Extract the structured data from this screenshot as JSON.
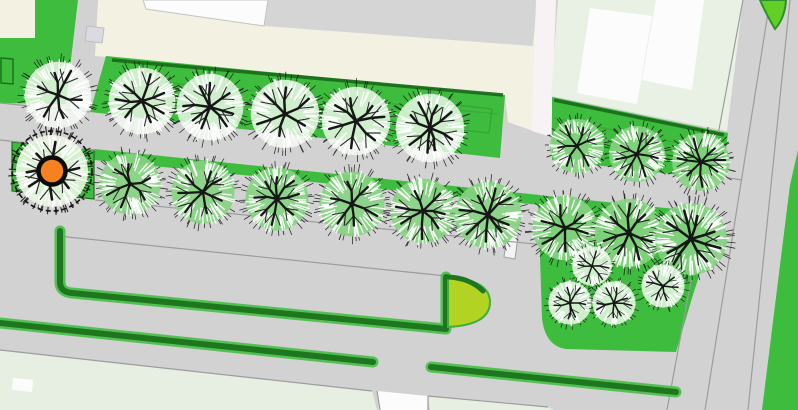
{
  "map": {
    "width": 798,
    "height": 410,
    "colors": {
      "base": "#d2d2d2",
      "road_line": "#9c9c9c",
      "lawn": "#3ebc3e",
      "lawn_dark_line": "#1a6e1a",
      "lawn_inner_line": "#35a435",
      "cream": "#f3f2e2",
      "top_gray": "#d5d5d5",
      "white": "#fcfcfc",
      "pale_block": "#e9f1e5",
      "pale_bottom": "#e7efe3",
      "pink_band": "#f7f2f3",
      "hedge_dark": "#1e761e",
      "hedge_light": "#54c054",
      "bulb": "#b3d322",
      "bulb_edge": "#3fae3f",
      "island": "#62cf25",
      "island_edge": "#2f8f2f",
      "marker": "#f58220",
      "marker_ring": "#0a0a0a",
      "branch": "#161616",
      "fuzz_white": "#ffffff",
      "crown_white": "#f7fcf5",
      "crown_green": "#85d381",
      "crown_pale": "#eaf5e3",
      "structure_fill": "#f4f4f4",
      "structure_edge": "#9f9f9f",
      "gray_square": "#dadae0"
    },
    "areas": [
      {
        "name": "building-block-cream",
        "fill": "cream",
        "points": [
          [
            98,
            0
          ],
          [
            537,
            0
          ],
          [
            536,
            132
          ],
          [
            508,
            122
          ],
          [
            505,
            96
          ],
          [
            110,
            57
          ],
          [
            95,
            56
          ]
        ]
      },
      {
        "name": "pavement-top",
        "fill": "top_gray",
        "points": [
          [
            268,
            0
          ],
          [
            537,
            0
          ],
          [
            533,
            46
          ],
          [
            264,
            26
          ]
        ]
      },
      {
        "name": "building-roof-white",
        "fill": "white",
        "stroke": "#c3c3c3",
        "sw": 1,
        "points": [
          [
            143,
            0
          ],
          [
            268,
            0
          ],
          [
            264,
            26
          ],
          [
            146,
            9
          ]
        ]
      },
      {
        "name": "building-wall-band",
        "fill": "pink_band",
        "points": [
          [
            536,
            0
          ],
          [
            556,
            0
          ],
          [
            551,
            137
          ],
          [
            532,
            131
          ]
        ]
      },
      {
        "name": "building-block-pale",
        "fill": "pale_block",
        "points": [
          [
            558,
            0
          ],
          [
            743,
            0
          ],
          [
            727,
            131
          ],
          [
            551,
            96
          ]
        ]
      },
      {
        "name": "roof-panel-1",
        "fill": "white",
        "points": [
          [
            590,
            8
          ],
          [
            652,
            16
          ],
          [
            637,
            104
          ],
          [
            577,
            93
          ]
        ]
      },
      {
        "name": "roof-panel-2",
        "fill": "white",
        "points": [
          [
            656,
            0
          ],
          [
            704,
            0
          ],
          [
            692,
            90
          ],
          [
            642,
            80
          ]
        ]
      },
      {
        "name": "corner-plot-cream",
        "fill": "cream",
        "points": [
          [
            0,
            0
          ],
          [
            35,
            0
          ],
          [
            35,
            38
          ],
          [
            0,
            38
          ]
        ]
      },
      {
        "name": "green-strip-topleft",
        "fill": "lawn",
        "points": [
          [
            35,
            0
          ],
          [
            78,
            0
          ],
          [
            72,
            70
          ],
          [
            35,
            64
          ]
        ]
      },
      {
        "name": "green-block-left",
        "fill": "lawn",
        "points": [
          [
            0,
            38
          ],
          [
            35,
            38
          ],
          [
            35,
            64
          ],
          [
            72,
            70
          ],
          [
            66,
            104
          ],
          [
            0,
            103
          ]
        ]
      },
      {
        "name": "footpath-topleft",
        "fill": "base",
        "points": [
          [
            78,
            0
          ],
          [
            98,
            0
          ],
          [
            88,
            104
          ],
          [
            66,
            102
          ]
        ]
      },
      {
        "name": "lawn-row1",
        "fill": "lawn",
        "points": [
          [
            106,
            56
          ],
          [
            505,
            95
          ],
          [
            500,
            158
          ],
          [
            90,
            112
          ]
        ]
      },
      {
        "name": "lawn-topright-strip",
        "fill": "lawn",
        "points": [
          [
            552,
            97
          ],
          [
            728,
            133
          ],
          [
            722,
            180
          ],
          [
            552,
            160
          ]
        ]
      },
      {
        "name": "planting-strip-row2",
        "fill": "lawn",
        "points": [
          [
            94,
            149
          ],
          [
            540,
            195
          ],
          [
            540,
            205
          ],
          [
            94,
            160
          ]
        ]
      },
      {
        "name": "planting-bed-row2",
        "fill": "lawn",
        "stroke": "#1a6e1a",
        "sw": 1.2,
        "points": [
          [
            12,
            142
          ],
          [
            94,
            150
          ],
          [
            94,
            199
          ],
          [
            12,
            191
          ]
        ]
      },
      {
        "name": "park-green",
        "fill": "lawn",
        "path": "M538,195 L714,213 L706,254 L692,298 L676,352 L566,349 Q545,346 542,318 Z"
      },
      {
        "name": "pale-verge-bottomleft",
        "fill": "pale_bottom",
        "points": [
          [
            0,
            350
          ],
          [
            372,
            391
          ],
          [
            377,
            410
          ],
          [
            0,
            410
          ]
        ]
      },
      {
        "name": "driveway-white",
        "fill": "white",
        "points": [
          [
            377,
            391
          ],
          [
            428,
            396
          ],
          [
            428,
            410
          ],
          [
            379,
            410
          ]
        ]
      },
      {
        "name": "pale-verge-bottommid",
        "fill": "pale_bottom",
        "points": [
          [
            428,
            396
          ],
          [
            548,
            407
          ],
          [
            554,
            410
          ],
          [
            430,
            410
          ]
        ]
      },
      {
        "name": "green-verge-right",
        "fill": "lawn",
        "points": [
          [
            798,
            150
          ],
          [
            790,
            185
          ],
          [
            762,
            410
          ],
          [
            798,
            410
          ]
        ]
      },
      {
        "name": "white-slab-bottomleft",
        "fill": "white",
        "points": [
          [
            13,
            378
          ],
          [
            33,
            380
          ],
          [
            32,
            392
          ],
          [
            12,
            390
          ]
        ]
      },
      {
        "name": "gray-square-topleft",
        "fill": "gray_square",
        "stroke": "#bcbcc4",
        "sw": 1,
        "points": [
          [
            87,
            26
          ],
          [
            104,
            28
          ],
          [
            102,
            43
          ],
          [
            85,
            41
          ]
        ]
      }
    ],
    "outline_rects": [
      {
        "name": "green-box-leftedge",
        "stroke": "lawn_dark_line",
        "sw": 1.4,
        "points": [
          [
            1,
            58
          ],
          [
            13,
            59
          ],
          [
            13,
            84
          ],
          [
            1,
            83
          ]
        ]
      },
      {
        "name": "lawn-bed-outline",
        "stroke": "lawn_inner_line",
        "sw": 1.3,
        "points": [
          [
            448,
            104
          ],
          [
            492,
            109
          ],
          [
            489,
            133
          ],
          [
            445,
            128
          ]
        ]
      },
      {
        "name": "bench-structure-row2",
        "fill": "structure_fill",
        "stroke": "structure_edge",
        "sw": 1,
        "points": [
          [
            507,
            234
          ],
          [
            518,
            236
          ],
          [
            515,
            259
          ],
          [
            504,
            257
          ]
        ]
      },
      {
        "name": "bench-structure-park",
        "fill": "structure_fill",
        "stroke": "structure_edge",
        "sw": 1,
        "points": [
          [
            700,
            249
          ],
          [
            716,
            251
          ],
          [
            713,
            271
          ],
          [
            697,
            269
          ]
        ]
      }
    ],
    "road_lines": [
      {
        "name": "road1-top-left",
        "pts": [
          [
            0,
            103
          ],
          [
            90,
            112
          ]
        ]
      },
      {
        "name": "road1-bottom-left",
        "pts": [
          [
            0,
            140
          ],
          [
            95,
            150
          ]
        ]
      },
      {
        "name": "curb-row2",
        "pts": [
          [
            95,
            200
          ],
          [
            545,
            245
          ]
        ]
      },
      {
        "name": "parking-edge",
        "pts": [
          [
            58,
            236
          ],
          [
            466,
            278
          ]
        ]
      },
      {
        "name": "verge-edge-left",
        "pts": [
          [
            0,
            350
          ],
          [
            372,
            391
          ]
        ]
      },
      {
        "name": "verge-edge-mid",
        "pts": [
          [
            428,
            396
          ],
          [
            548,
            407
          ]
        ]
      },
      {
        "name": "driveway-edge-left",
        "pts": [
          [
            377,
            391
          ],
          [
            380,
            410
          ]
        ]
      },
      {
        "name": "driveway-edge-right",
        "pts": [
          [
            428,
            396
          ],
          [
            428,
            410
          ]
        ]
      },
      {
        "name": "crossroad-edge-1",
        "pts": [
          [
            743,
            0
          ],
          [
            667,
            410
          ]
        ]
      },
      {
        "name": "crossroad-edge-2",
        "pts": [
          [
            770,
            0
          ],
          [
            705,
            410
          ]
        ]
      },
      {
        "name": "crossroad-edge-3",
        "pts": [
          [
            790,
            0
          ],
          [
            748,
            410
          ]
        ]
      },
      {
        "name": "strip-road-join",
        "pts": [
          [
            722,
            177
          ],
          [
            742,
            180
          ]
        ]
      }
    ],
    "green_lines": [
      {
        "name": "hedge-line-lawn-top",
        "pts": [
          [
            112,
            60
          ],
          [
            503,
            95
          ]
        ],
        "w": 3.5,
        "color": "lawn_dark_line",
        "op": 0.95
      },
      {
        "name": "hedge-line-strip-top",
        "pts": [
          [
            554,
            100
          ],
          [
            724,
            135
          ]
        ],
        "w": 3.5,
        "color": "lawn_dark_line",
        "op": 0.95
      },
      {
        "name": "lawn-terrace-line-1",
        "pts": [
          [
            118,
            78
          ],
          [
            498,
            114
          ]
        ],
        "w": 1.2,
        "color": "lawn_inner_line",
        "op": 0.7
      },
      {
        "name": "lawn-terrace-line-2",
        "pts": [
          [
            118,
            94
          ],
          [
            470,
            128
          ]
        ],
        "w": 1.2,
        "color": "lawn_inner_line",
        "op": 0.55
      },
      {
        "name": "strip-terrace-line",
        "pts": [
          [
            554,
            118
          ],
          [
            723,
            152
          ]
        ],
        "w": 1.2,
        "color": "lawn_inner_line",
        "op": 0.7
      }
    ],
    "hedges": [
      {
        "name": "hedge-parking-L",
        "path": "M 60 231 L 60 282 Q 60 292 72 293 L 446 329 L 446 277"
      },
      {
        "name": "hedge-south-a",
        "path": "M 0 323 L 373 362"
      },
      {
        "name": "hedge-south-b",
        "path": "M 431 367 L 676 392"
      }
    ],
    "bulb": {
      "name": "shrub-bulb",
      "path": "M448,277 Q490,280 490,302 Q490,325 448,327 Z",
      "cap": "M448,277 Q470,278 483,291"
    },
    "island": {
      "name": "traffic-island-leaf",
      "path": "M760,0 L786,0 Q785,18 775,29 Q765,12 760,0 Z"
    },
    "trees": [
      {
        "x": 58,
        "y": 95,
        "r": 37,
        "tint": "white"
      },
      {
        "x": 142,
        "y": 101,
        "r": 37,
        "tint": "white"
      },
      {
        "x": 210,
        "y": 107,
        "r": 37,
        "tint": "white"
      },
      {
        "x": 285,
        "y": 114,
        "r": 38,
        "tint": "white"
      },
      {
        "x": 356,
        "y": 121,
        "r": 38,
        "tint": "white"
      },
      {
        "x": 430,
        "y": 128,
        "r": 38,
        "tint": "white"
      },
      {
        "x": 577,
        "y": 146,
        "r": 30,
        "tint": "green"
      },
      {
        "x": 637,
        "y": 154,
        "r": 31,
        "tint": "green"
      },
      {
        "x": 701,
        "y": 162,
        "r": 32,
        "tint": "green"
      },
      {
        "x": 130,
        "y": 184,
        "r": 34,
        "tint": "green"
      },
      {
        "x": 203,
        "y": 192,
        "r": 35,
        "tint": "green"
      },
      {
        "x": 277,
        "y": 199,
        "r": 35,
        "tint": "green"
      },
      {
        "x": 352,
        "y": 204,
        "r": 36,
        "tint": "green"
      },
      {
        "x": 423,
        "y": 211,
        "r": 36,
        "tint": "green"
      },
      {
        "x": 488,
        "y": 215,
        "r": 37,
        "tint": "green"
      },
      {
        "x": 565,
        "y": 228,
        "r": 36,
        "tint": "green"
      },
      {
        "x": 629,
        "y": 233,
        "r": 38,
        "tint": "green"
      },
      {
        "x": 691,
        "y": 239,
        "r": 40,
        "tint": "green"
      },
      {
        "x": 592,
        "y": 266,
        "r": 22,
        "tint": "white"
      },
      {
        "x": 570,
        "y": 303,
        "r": 24,
        "tint": "white"
      },
      {
        "x": 614,
        "y": 303,
        "r": 24,
        "tint": "white"
      },
      {
        "x": 663,
        "y": 286,
        "r": 24,
        "tint": "white"
      },
      {
        "x": 52,
        "y": 171,
        "r": 40,
        "tint": "pale",
        "selected": true
      }
    ],
    "marker": {
      "name": "selected-tree-marker",
      "x": 52,
      "y": 171,
      "r": 13.5,
      "ring_width": 4.5
    }
  }
}
